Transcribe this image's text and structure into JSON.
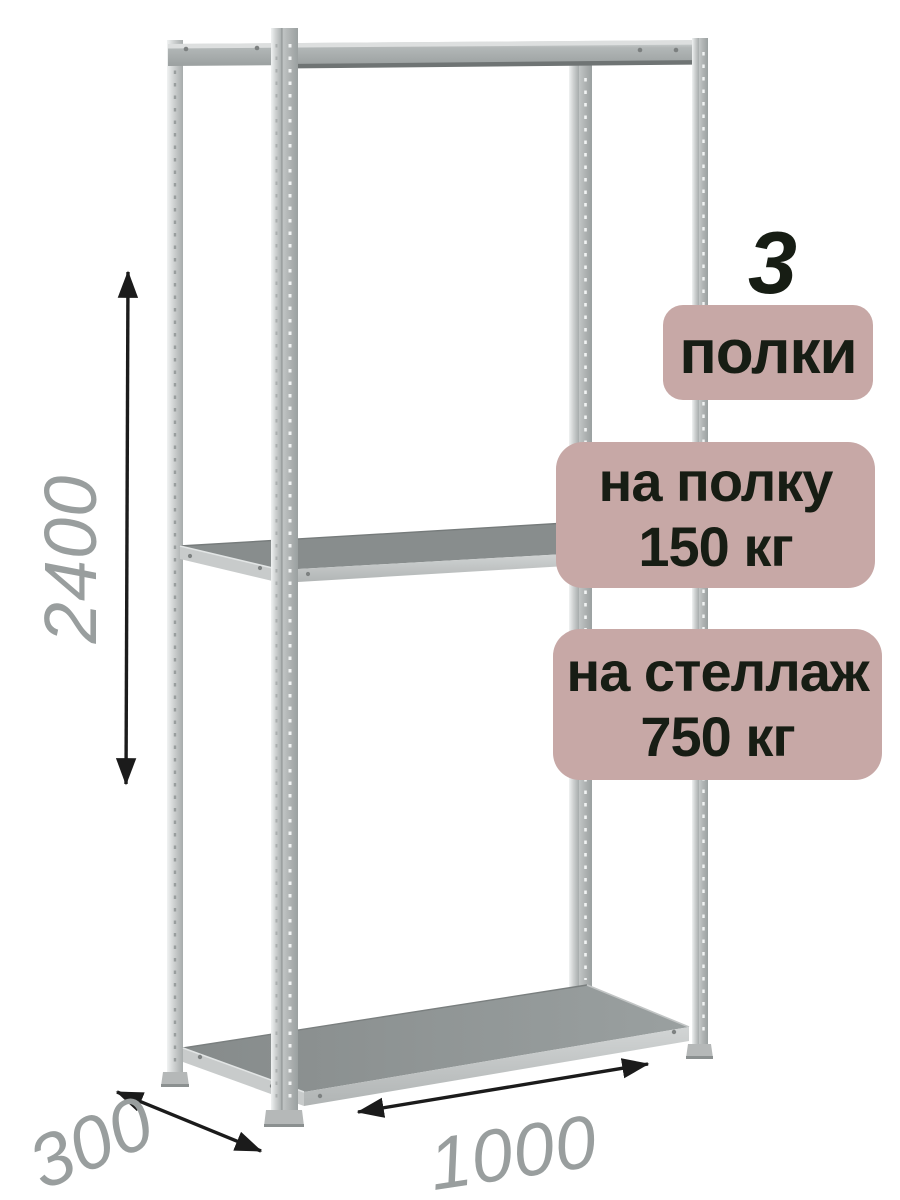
{
  "badges": {
    "count": {
      "number": "3",
      "label": "полки"
    },
    "shelf_load": {
      "line1": "на полку",
      "line2": "150 кг"
    },
    "rack_load": {
      "line1": "на стеллаж",
      "line2": "750 кг"
    }
  },
  "dimensions": {
    "height_mm": "2400",
    "depth_mm": "300",
    "width_mm": "1000"
  },
  "illustration": {
    "subject": "metal-boltless-shelving-rack",
    "shelf_count": 3,
    "posts": 4
  },
  "colors": {
    "background": "#ffffff",
    "badge_bg": "#c7a8a6",
    "badge_text": "#171d14",
    "dimension_text": "#999e9e",
    "arrow": "#1b1b1b",
    "metal_light": "#d6d9d9",
    "metal_mid": "#aeb2b2",
    "shelf_top": "#8a8f8f",
    "shelf_edge": "#c4c7c7"
  }
}
